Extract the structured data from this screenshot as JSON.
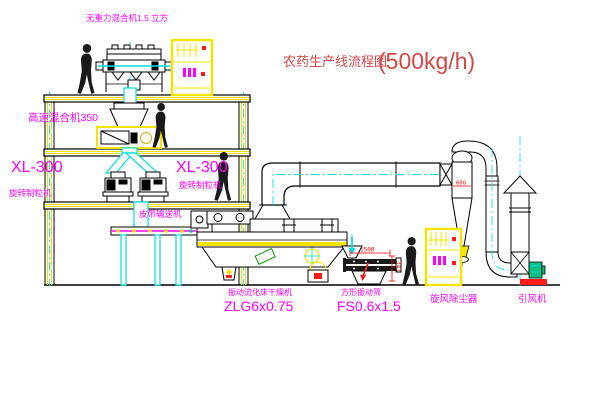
{
  "title": {
    "name_zh": "农药生产线流程图",
    "capacity": "(500kg/h)"
  },
  "equipment_labels": {
    "no_gravity_mixer": "无重力混合机1.5 立方",
    "high_speed_mixer": "高速混合机350",
    "granulator_left_model": "XL-300",
    "granulator_left_name": "旋转制粒机",
    "granulator_mid_model": "XL-300",
    "granulator_mid_name": "旋转制粒机",
    "belt_conveyor": "皮带输送机",
    "fluid_bed_dryer_name": "振动流化床干燥机",
    "fluid_bed_dryer_model": "ZLG6x0.75",
    "vibrating_screen_name": "方形振动筛",
    "vibrating_screen_model": "FS0.6x1.5",
    "cyclone_dust_collector": "旋风除尘器",
    "induced_draft_fan": "引风机"
  },
  "dimensions": {
    "screen_length": "1500",
    "screen_outlet_height": "341",
    "cyclone_diameter": "600"
  },
  "colors": {
    "label_magenta": "#ff00ff",
    "title_red": "#d34747",
    "dimension_red": "#ff0000",
    "structure_yellow": "#ffff00",
    "centerline_cyan": "#00e0e0",
    "line_black": "#000000",
    "fan_green": "#10c080",
    "base_red": "#ff1a1a"
  }
}
